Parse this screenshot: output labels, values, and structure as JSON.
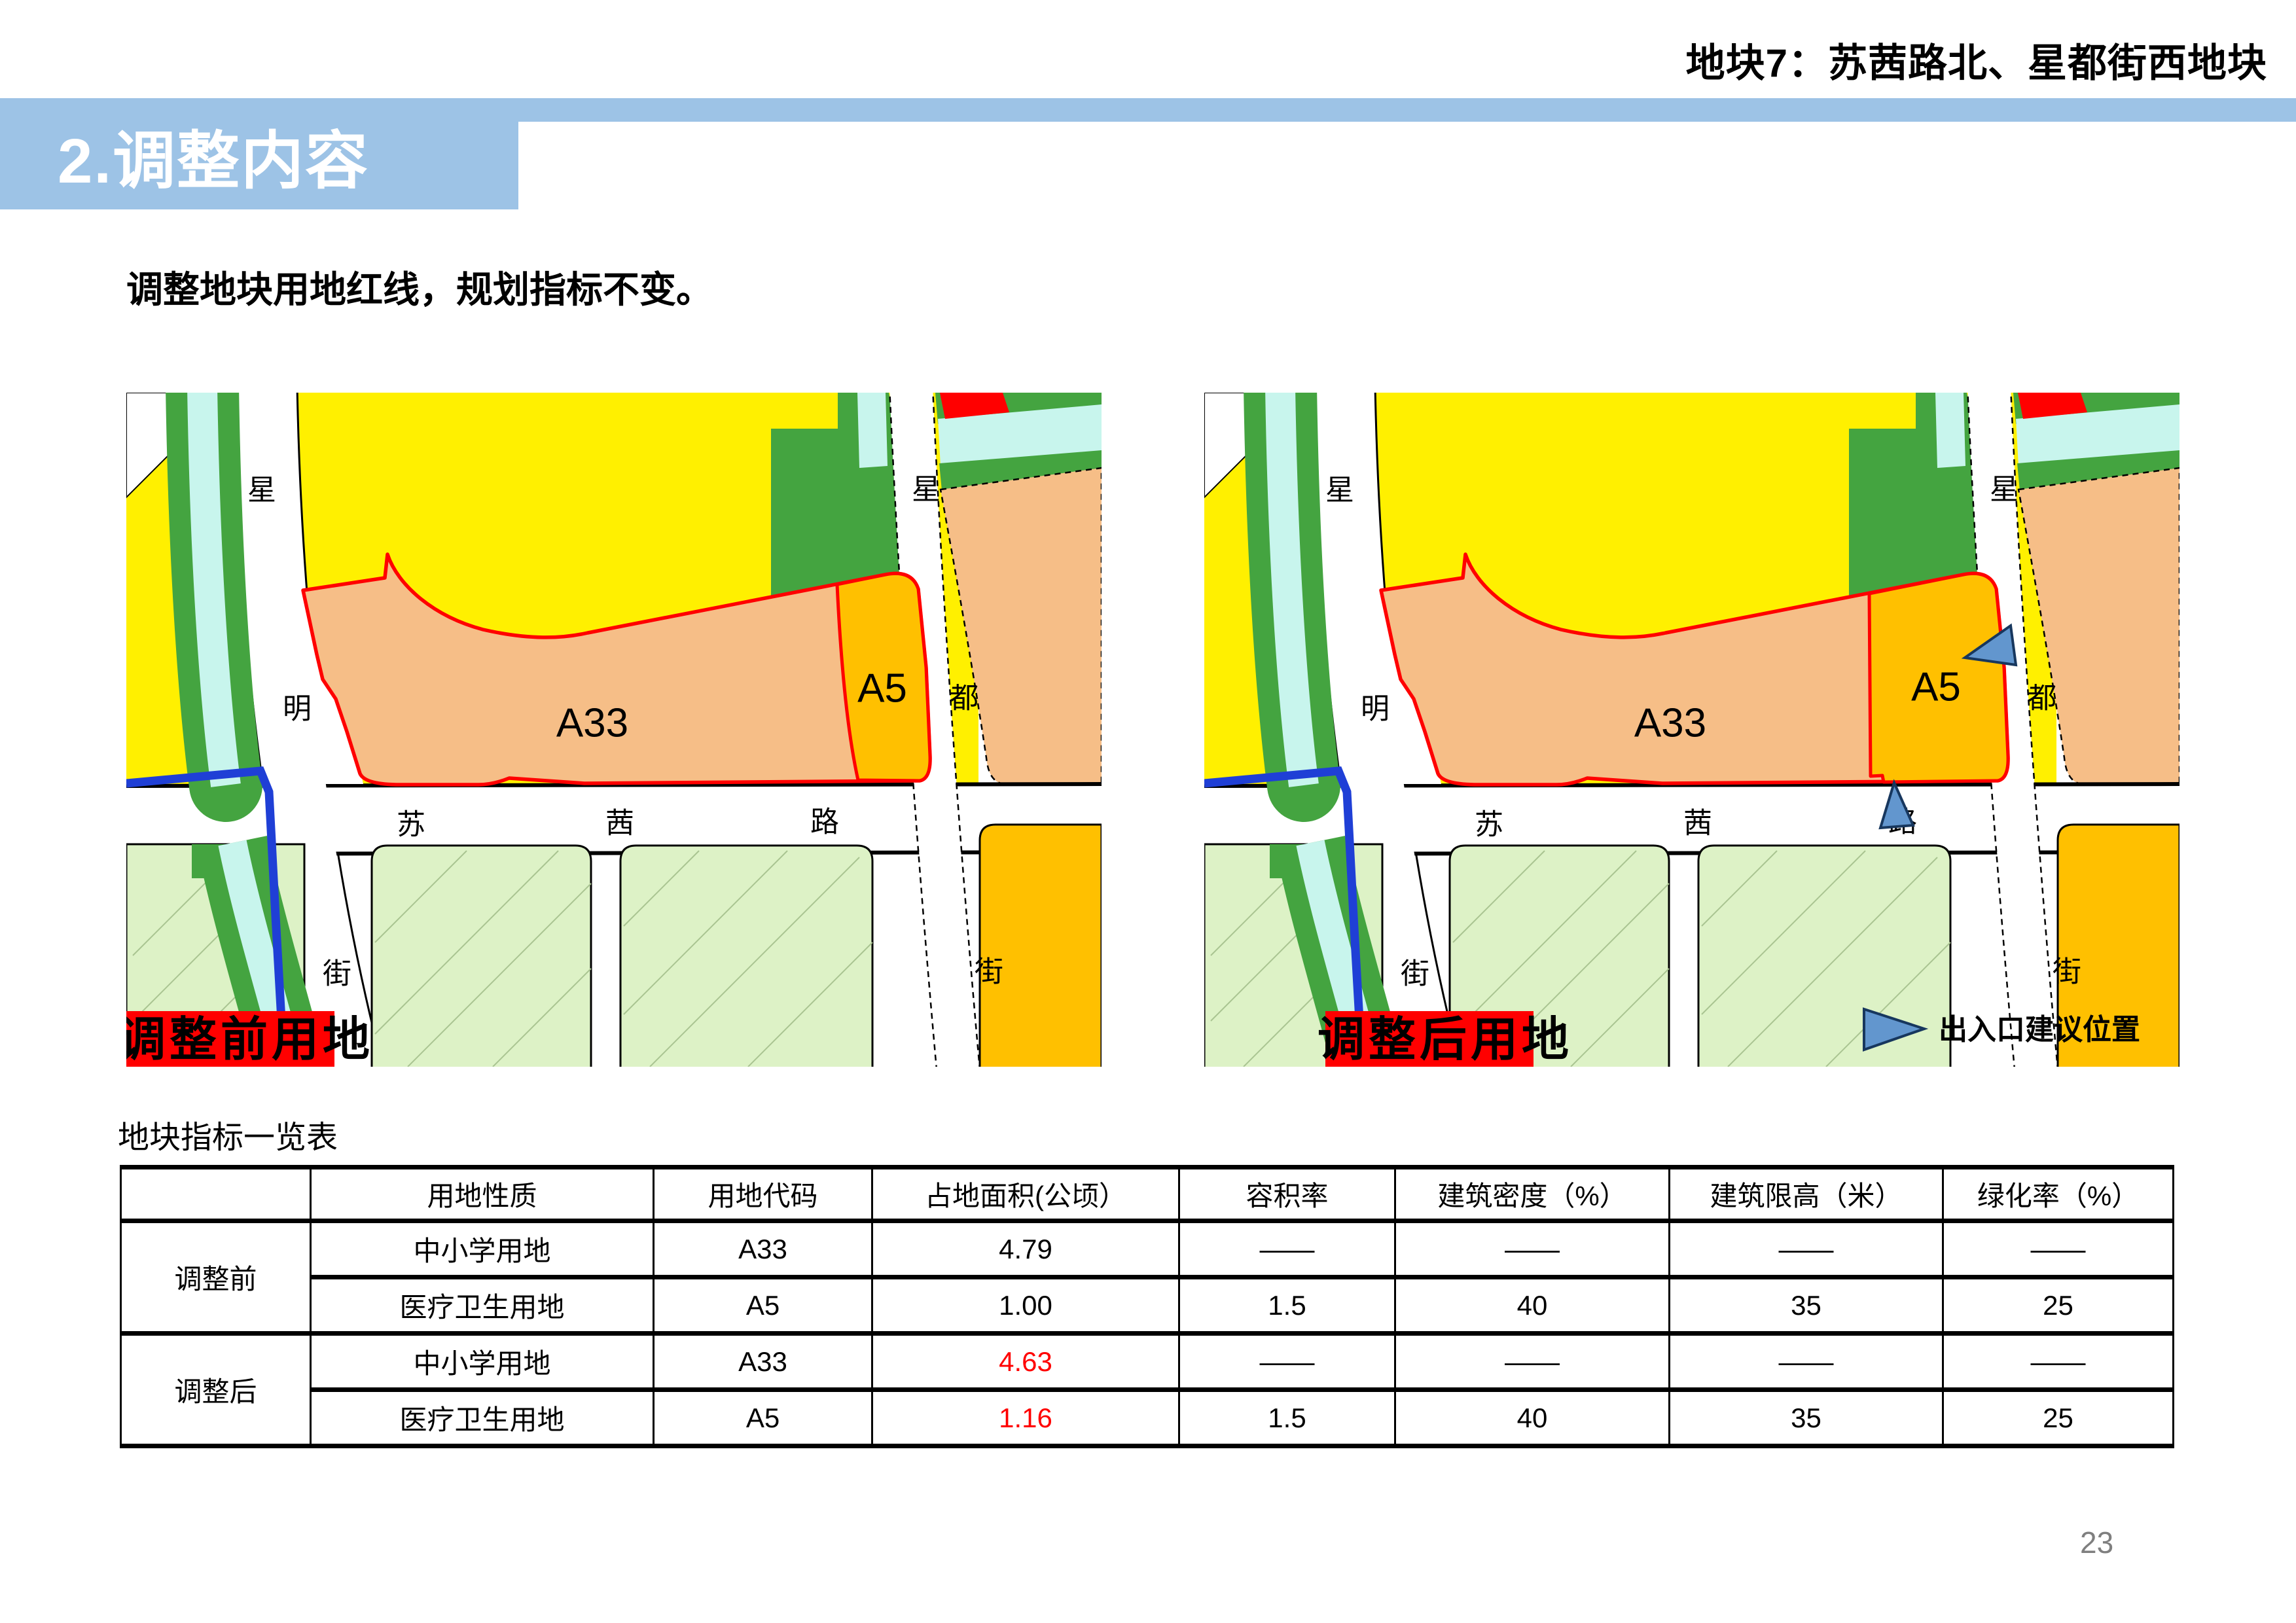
{
  "page": {
    "number": "23",
    "background_color": "#FFFFFF"
  },
  "header": {
    "plot_title": "地块7：苏茜路北、星都街西地块",
    "section_title": "2.调整内容",
    "subtitle": "调整地块用地红线，规划指标不变。",
    "accent_color": "#9DC3E6"
  },
  "maps": {
    "shared": {
      "labels": {
        "road_left": [
          "星",
          "明",
          "街"
        ],
        "road_horizontal": [
          "苏",
          "茜",
          "路"
        ],
        "road_right": [
          "星",
          "都",
          "街"
        ],
        "plot_a33": "A33",
        "plot_a5": "A5"
      },
      "colors": {
        "residential_yellow": "#FFF000",
        "school_salmon": "#F6BE87",
        "medical_orange": "#FFC000",
        "greenbelt": "#44A440",
        "canal_cyan": "#C8F5ED",
        "south_plot_green": "#DDF2C6",
        "red_line": "#FF0000",
        "boundary_blue": "#1F3FD6",
        "arrow_blue": "#6296CE"
      }
    },
    "before": {
      "caption": "调整前用地"
    },
    "after": {
      "caption": "调整后用地",
      "legend_label": "出入口建议位置"
    }
  },
  "table": {
    "title": "地块指标一览表",
    "highlight_color": "#FF0000",
    "headers": [
      "",
      "用地性质",
      "用地代码",
      "占地面积(公顷）",
      "容积率",
      "建筑密度（%）",
      "建筑限高（米）",
      "绿化率（%）"
    ],
    "groups": [
      {
        "label": "调整前",
        "rows": [
          [
            "中小学用地",
            "A33",
            "4.79",
            "——",
            "——",
            "——",
            "——"
          ],
          [
            "医疗卫生用地",
            "A5",
            "1.00",
            "1.5",
            "40",
            "35",
            "25"
          ]
        ]
      },
      {
        "label": "调整后",
        "rows": [
          [
            "中小学用地",
            "A33",
            "4.63",
            "——",
            "——",
            "——",
            "——"
          ],
          [
            "医疗卫生用地",
            "A5",
            "1.16",
            "1.5",
            "40",
            "35",
            "25"
          ]
        ]
      }
    ]
  }
}
